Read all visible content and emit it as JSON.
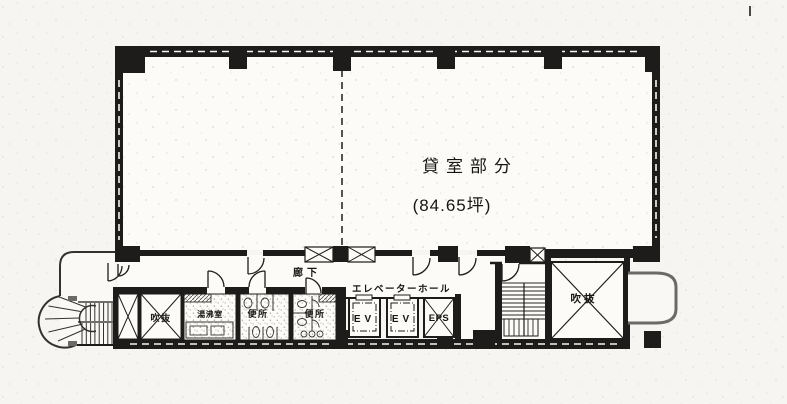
{
  "plan": {
    "rental_room": {
      "name": "貸室部分",
      "area": "(84.65坪)"
    },
    "corridor": {
      "label": "廊下"
    },
    "elevator_hall": {
      "label": "エレベーターホール",
      "ev1": "EV",
      "ev2": "EV",
      "eps": "EPS"
    },
    "rooms": {
      "atrium_left": "吹抜",
      "atrium_right": "吹抜",
      "kitchenette": "湯沸室",
      "toilet_men": "便所",
      "toilet_women": "便所"
    }
  },
  "colors": {
    "ink": "#1d1c1a",
    "paper": "#f6f5f1",
    "stipple": "#8e8b80"
  }
}
